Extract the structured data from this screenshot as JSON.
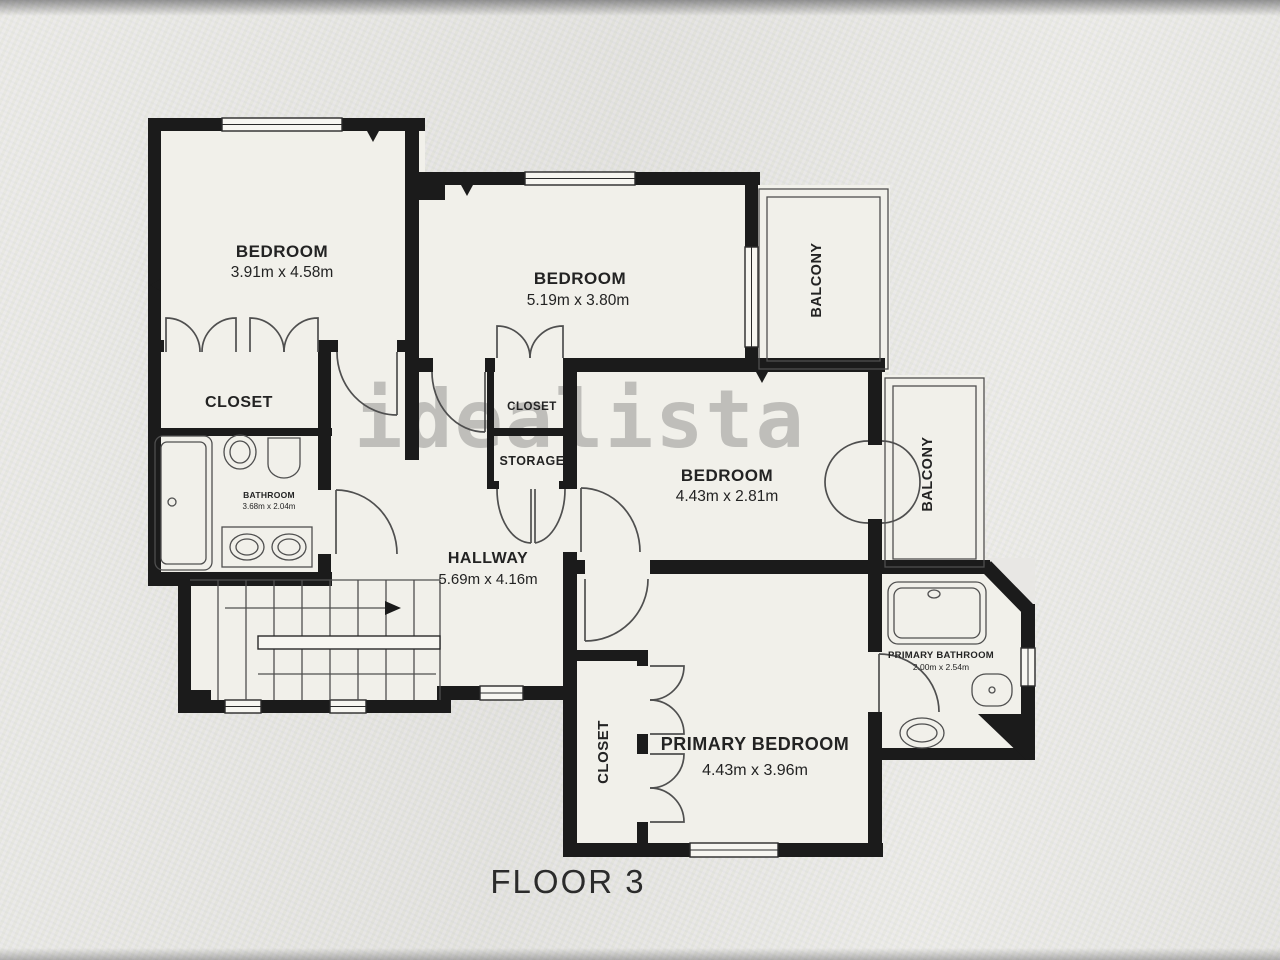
{
  "floor_plan": {
    "watermark": "idealista",
    "floor_label": "FLOOR 3",
    "rooms": {
      "bedroom1": {
        "name": "BEDROOM",
        "dims": "3.91m x 4.58m"
      },
      "bedroom2": {
        "name": "BEDROOM",
        "dims": "5.19m x 3.80m"
      },
      "bedroom3": {
        "name": "BEDROOM",
        "dims": "4.43m x 2.81m"
      },
      "primary_bedroom": {
        "name": "PRIMARY BEDROOM",
        "dims": "4.43m x 3.96m"
      },
      "hallway": {
        "name": "HALLWAY",
        "dims": "5.69m x 4.16m"
      },
      "bathroom": {
        "name": "BATHROOM",
        "dims": "3.68m x 2.04m"
      },
      "primary_bathroom": {
        "name": "PRIMARY BATHROOM",
        "dims": "2.00m x 2.54m"
      },
      "closet1": {
        "name": "CLOSET"
      },
      "closet2": {
        "name": "CLOSET"
      },
      "storage": {
        "name": "STORAGE"
      },
      "closet3": {
        "name": "CLOSET"
      },
      "balcony1": {
        "name": "BALCONY"
      },
      "balcony2": {
        "name": "BALCONY"
      }
    },
    "colors": {
      "wall": "#1b1b1b",
      "line": "#4f4f4f",
      "fill": "#f1f0ea",
      "winfill": "#f7f6f1",
      "background": "#e8e7e4",
      "watermark": "#8e8e8c",
      "text": "#232323"
    }
  }
}
